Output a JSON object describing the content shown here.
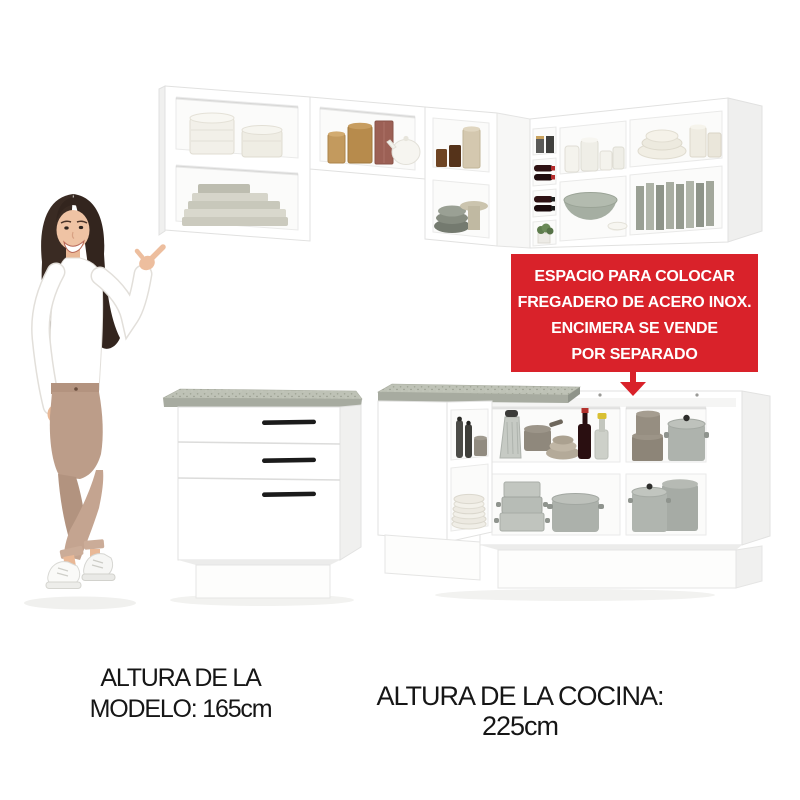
{
  "banner": {
    "lines": [
      "ESPACIO PARA COLOCAR",
      "FREGADERO DE ACERO INOX.",
      "ENCIMERA SE VENDE",
      "POR SEPARADO"
    ],
    "arrow_icon": "down-arrow-icon",
    "bg_color": "#d9222a",
    "text_color": "#ffffff"
  },
  "captions": {
    "model_height_line1": "ALTURA DE LA",
    "model_height_line2": "MODELO: 165cm",
    "kitchen_height": "ALTURA DE LA COCINA: 225cm"
  },
  "colors": {
    "banner_red": "#d9222a",
    "cabinet_white": "#ffffff",
    "countertop_gray": "#b5b9ad",
    "caption_text": "#161616"
  }
}
